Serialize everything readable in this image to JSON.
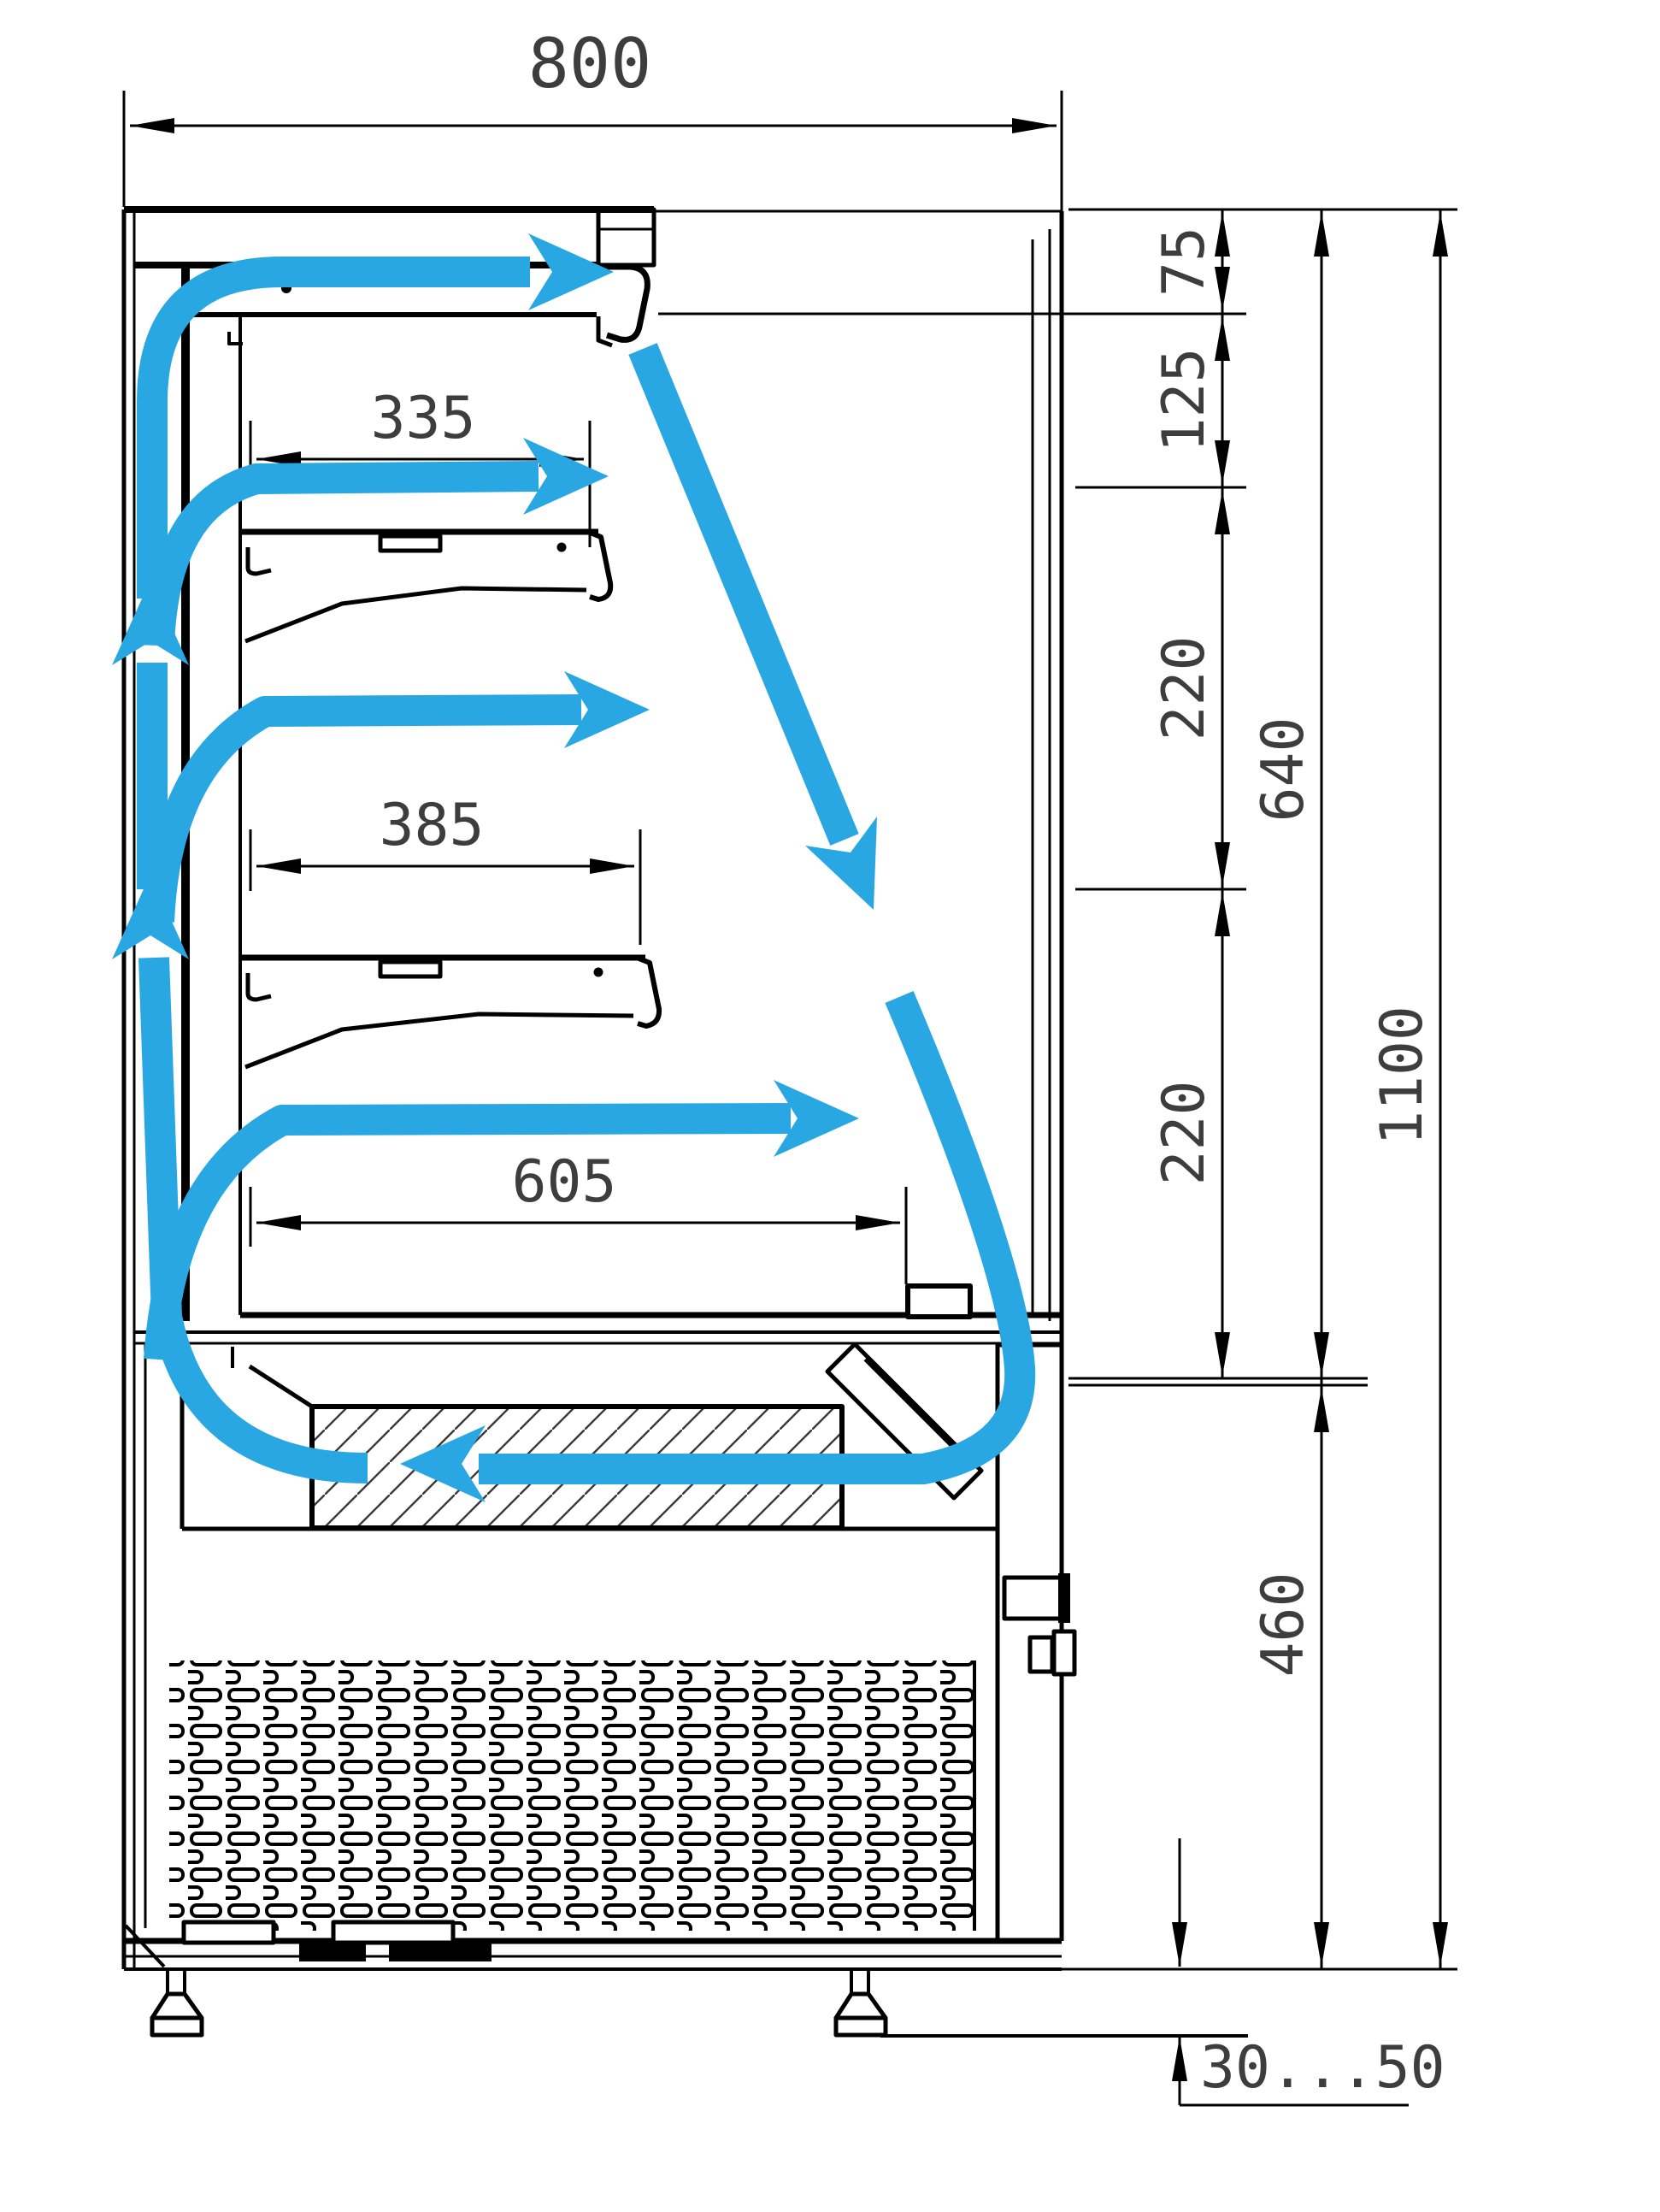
{
  "drawing": {
    "type": "technical-cross-section",
    "subject": "refrigerated open display case side view with air circulation"
  },
  "colors": {
    "line": "#000000",
    "dim": "#3d3d3d",
    "airflow": "#29a7e2",
    "bg": "#ffffff"
  },
  "dimensions": {
    "overall_depth": {
      "label": "800"
    },
    "shelf1_depth": {
      "label": "335"
    },
    "shelf2_depth": {
      "label": "385"
    },
    "deck_depth": {
      "label": "605"
    },
    "canopy_outlet_height": {
      "label": "75"
    },
    "outlet_to_shelf1": {
      "label": "125"
    },
    "shelf1_to_shelf2": {
      "label": "220"
    },
    "shelf2_to_deck": {
      "label": "220"
    },
    "display_opening_height": {
      "label": "640"
    },
    "overall_height": {
      "label": "1100"
    },
    "base_height": {
      "label": "460"
    },
    "foot_clearance": {
      "label": "30...50"
    }
  }
}
